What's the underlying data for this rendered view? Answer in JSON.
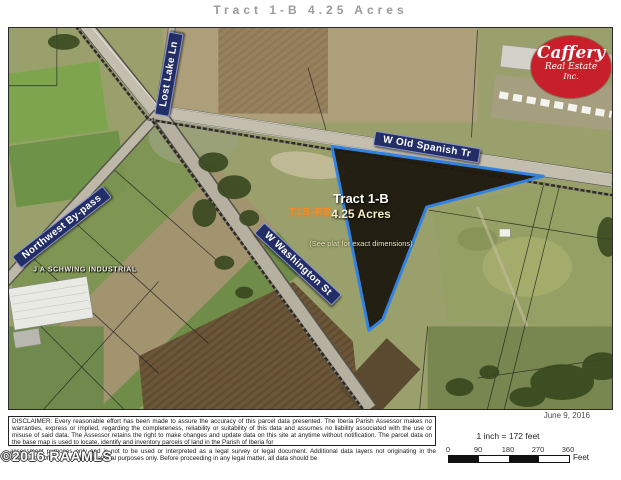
{
  "title": "Tract 1-B 4.25 Acres",
  "logo": {
    "name": "Caffery",
    "line2": "Real Estate",
    "line3": "Inc.",
    "bg_color": "#c8202a"
  },
  "map": {
    "banner_color": "#232e66",
    "road_labels": [
      {
        "id": "lost-lake-ln",
        "label": "Lost Lake Ln"
      },
      {
        "id": "w-old-spanish-tr",
        "label": "W Old Spanish Tr"
      },
      {
        "id": "northwest-by-pass",
        "label": "Northwest By-pass"
      },
      {
        "id": "w-washington-st",
        "label": "W Washington St"
      }
    ],
    "area_label": "J A SCHWING INDUSTRIAL",
    "tract": {
      "name": "Tract 1-B",
      "acreage": "4.25 Acres",
      "note": "(See plat for exact dimensions)",
      "outline_color": "#2f82e8"
    },
    "watermark": "T1B-RB"
  },
  "footer": {
    "disclaimer": "DISCLAIMER: Every reasonable effort has been made to assure the accuracy of this parcel data presented. The Iberia Parish Assessor makes no warranties, express or implied, regarding the completeness, reliability or suitability of this data and assumes no liability associated with the use or misuse of said data. The Assessor retains the right to make changes and update data on this site at anytime without notification. The parcel data on the base map is used to locate, identify and inventory parcels of land in the Parish of Iberia for",
    "disclaimer2": "assessment purposes only and is not to be used or interpreted as a legal survey or legal document. Additional data layers not originating in the Assessor's Office are for informational purposes only. Before proceeding in any legal matter, all data should be",
    "copyright": "©2016 RAAMLS",
    "date": "June 9, 2016",
    "scale": {
      "label": "1 inch = 172 feet",
      "ticks": [
        "0",
        "90",
        "180",
        "270",
        "360"
      ],
      "unit": "Feet"
    }
  }
}
